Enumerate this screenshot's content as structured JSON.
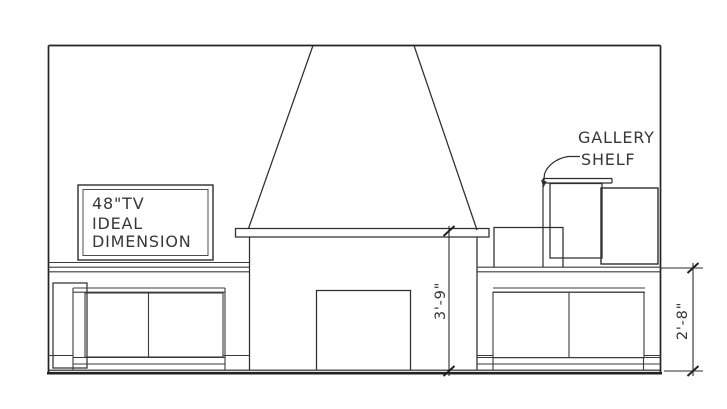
{
  "annotations": {
    "tv_note": {
      "lines": [
        "48\"TV",
        "IDEAL",
        "DIMENSION"
      ]
    },
    "gallery_shelf": {
      "lines": [
        "GALLERY",
        "SHELF"
      ]
    }
  },
  "dimensions": {
    "fireplace_opening_height": "3'-9\"",
    "counter_height": "2'-8\""
  },
  "colors": {
    "background": "#ffffff",
    "line": "#2e2e2e",
    "text": "#383838"
  }
}
